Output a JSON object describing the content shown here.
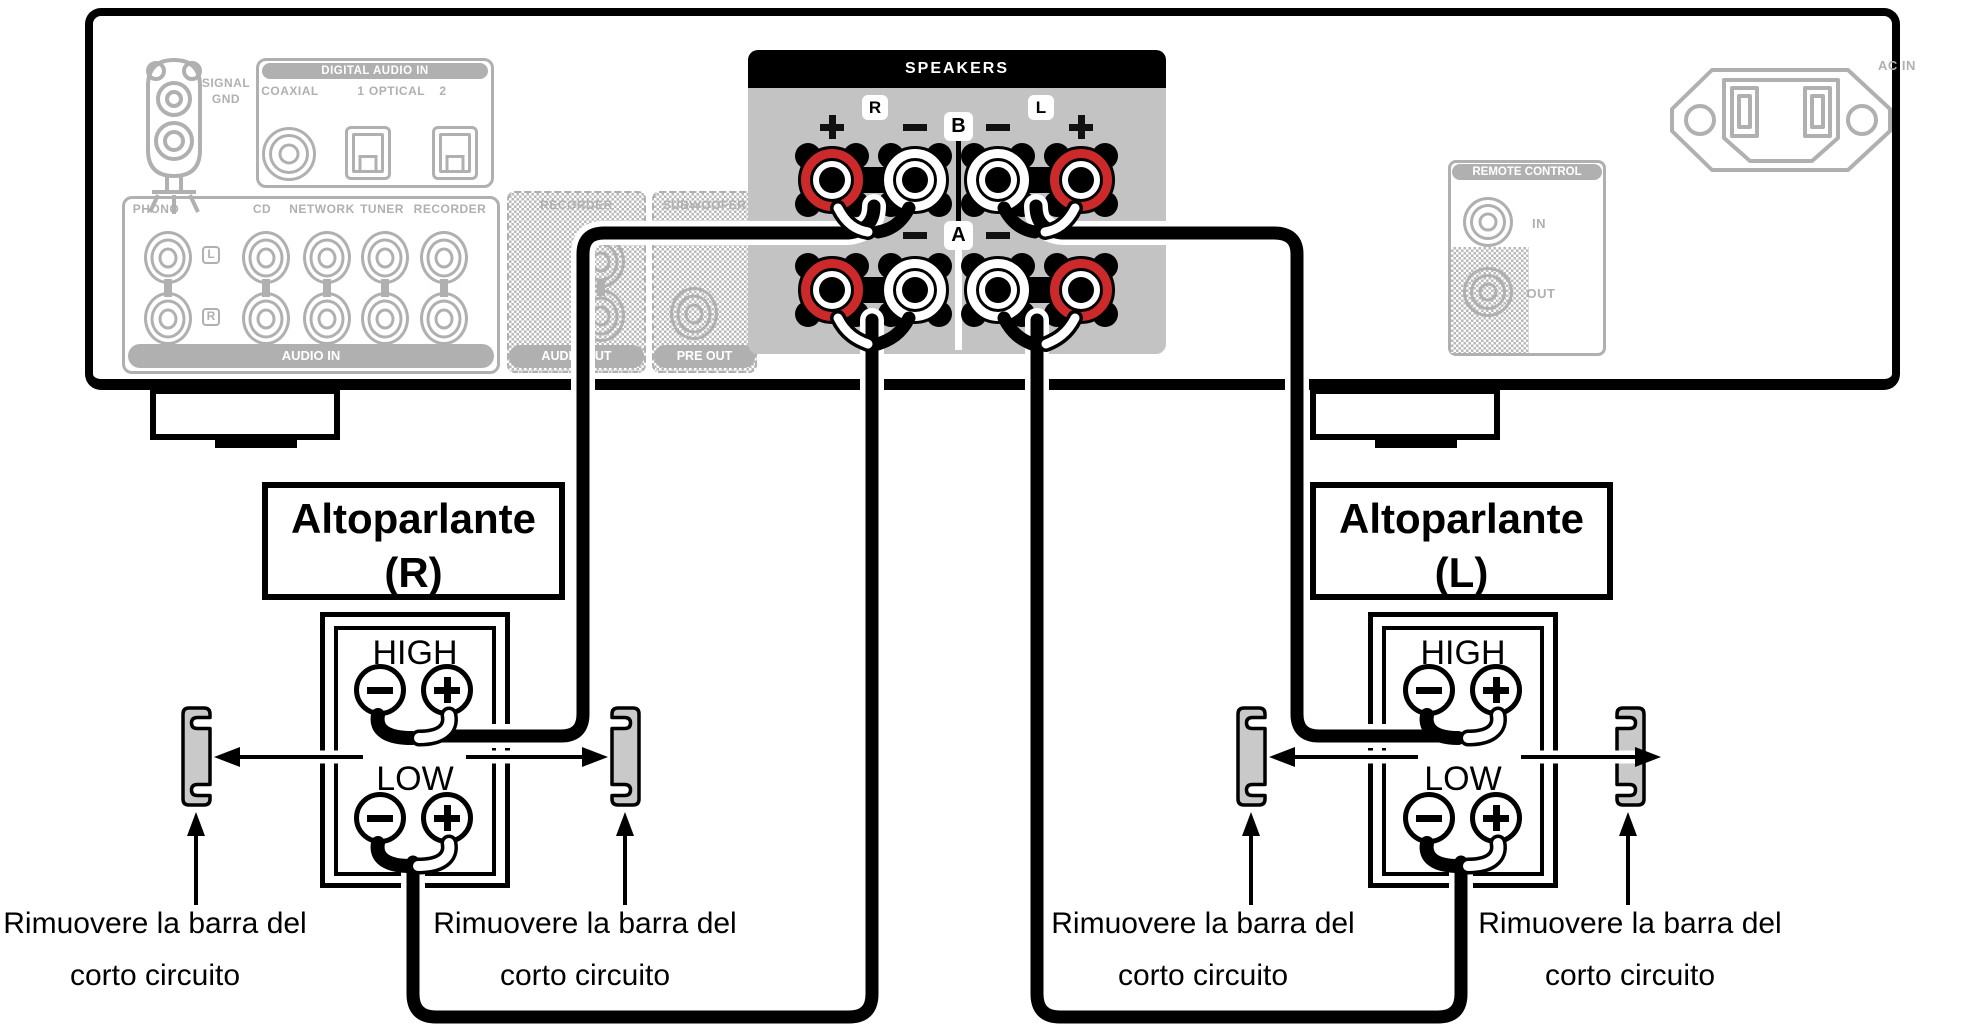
{
  "icons": {
    "plus": "+",
    "minus": "−"
  },
  "colors": {
    "terminal_red": "#cc2a2a",
    "panel_gray": "#c3c3c3",
    "ghost_gray": "#b0b0b0"
  },
  "amp": {
    "signal_gnd": {
      "line1": "SIGNAL",
      "line2": "GND"
    },
    "digital_audio_in": {
      "title": "DIGITAL AUDIO IN",
      "coaxial": "COAXIAL",
      "num1": "1",
      "optical": "OPTICAL",
      "num2": "2"
    },
    "audio_in": {
      "phono": "PHONO",
      "cd": "CD",
      "network": "NETWORK",
      "tuner": "TUNER",
      "recorder": "RECORDER",
      "left": "L",
      "right": "R",
      "band": "AUDIO IN"
    },
    "out_section": {
      "recorder": "RECORDER",
      "subwoofer": "SUBWOOFER",
      "audio_out": "AUDIO OUT",
      "pre_out": "PRE OUT"
    },
    "speakers": {
      "title": "SPEAKERS",
      "right": "R",
      "left": "L",
      "group_b": "B",
      "group_a": "A"
    },
    "remote": {
      "title": "REMOTE CONTROL",
      "in": "IN",
      "out": "OUT"
    },
    "ac_in": "AC IN"
  },
  "speaker_r": {
    "name": "Altoparlante",
    "channel": "(R)",
    "high": "HIGH",
    "low": "LOW"
  },
  "speaker_l": {
    "name": "Altoparlante",
    "channel": "(L)",
    "high": "HIGH",
    "low": "LOW"
  },
  "caption": {
    "line1": "Rimuovere la barra del",
    "line2": "corto circuito"
  }
}
